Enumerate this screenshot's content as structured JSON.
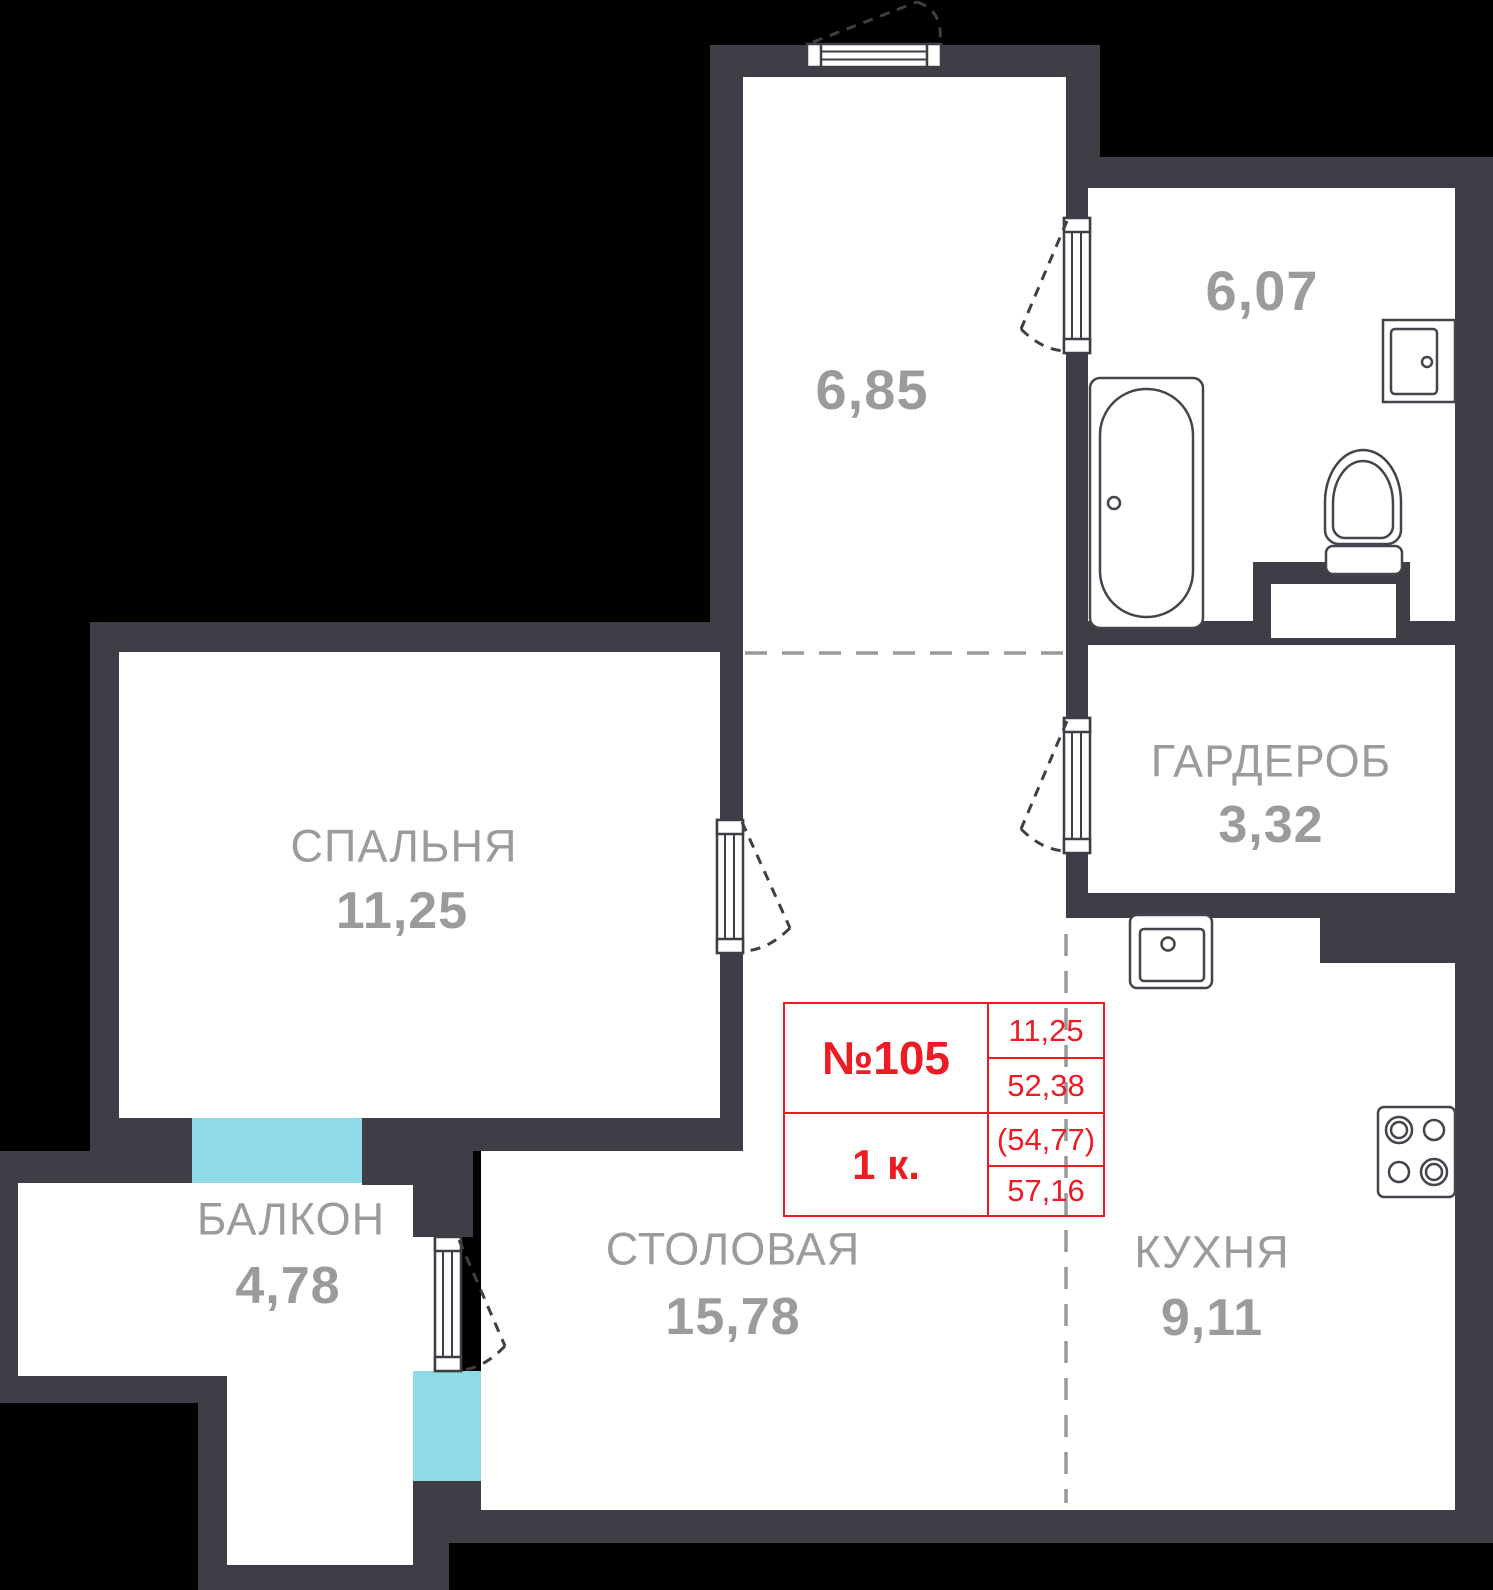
{
  "unit": {
    "number": "№105",
    "type": "1 к.",
    "living_area": "11,25",
    "area_main": "52,38",
    "area_with_coeff": "(54,77)",
    "area_total": "57,16"
  },
  "rooms": {
    "hallway": {
      "area": "6,85"
    },
    "bathroom": {
      "area": "6,07"
    },
    "wardrobe": {
      "name": "ГАРДЕРОБ",
      "area": "3,32"
    },
    "bedroom": {
      "name": "СПАЛЬНЯ",
      "area": "11,25"
    },
    "balcony": {
      "name": "БАЛКОН",
      "area": "4,78"
    },
    "dining": {
      "name": "СТОЛОВАЯ",
      "area": "15,78"
    },
    "kitchen": {
      "name": "КУХНЯ",
      "area": "9,11"
    }
  },
  "colors": {
    "wall": "#3F3E46",
    "window": "#8EDAE7",
    "label": "#9B9B9B",
    "accent_red": "#ED1C24",
    "guide_dash": "#999999",
    "background": "#000000"
  }
}
